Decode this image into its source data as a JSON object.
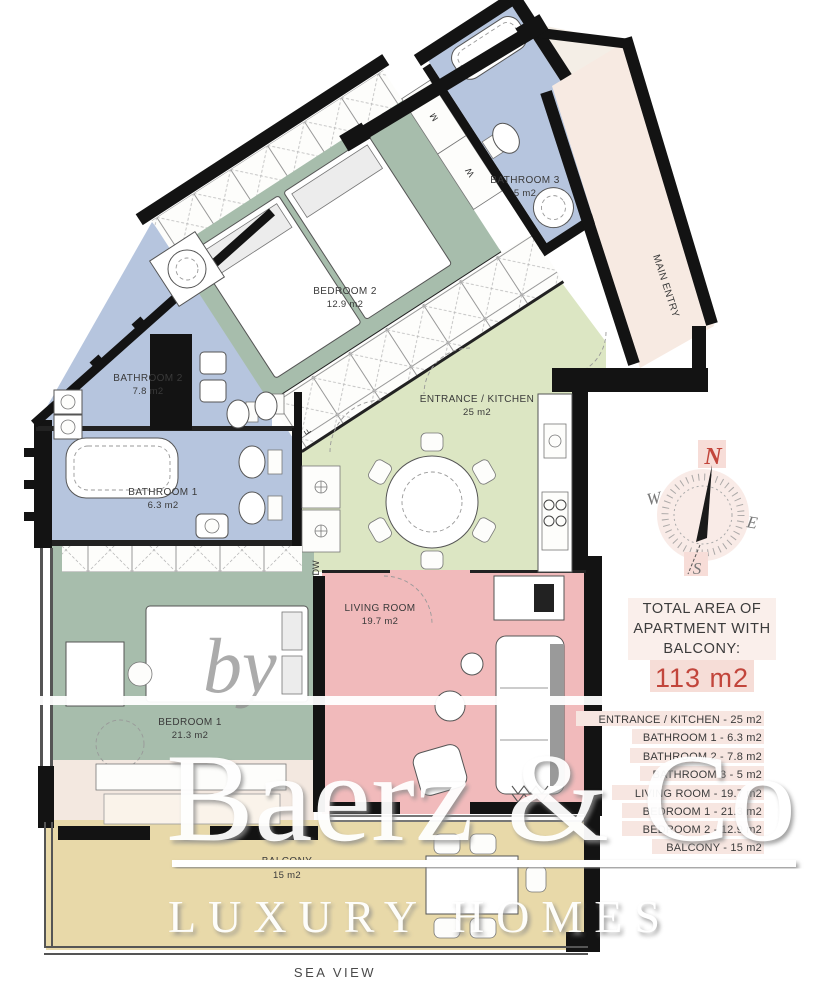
{
  "plan": {
    "rooms": [
      {
        "id": "bedroom2",
        "name": "BEDROOM 2",
        "area": "12.9 m2"
      },
      {
        "id": "bathroom3",
        "name": "BATHROOM 3",
        "area": "5 m2"
      },
      {
        "id": "bathroom2",
        "name": "BATHROOM 2",
        "area": "7.8 m2"
      },
      {
        "id": "bathroom1",
        "name": "BATHROOM 1",
        "area": "6.3 m2"
      },
      {
        "id": "kitchen",
        "name": "ENTRANCE / KITCHEN",
        "area": "25 m2"
      },
      {
        "id": "living",
        "name": "LIVING ROOM",
        "area": "19.7 m2"
      },
      {
        "id": "bedroom1",
        "name": "BEDROOM 1",
        "area": "21.3 m2"
      },
      {
        "id": "balcony",
        "name": "BALCONY",
        "area": "15 m2"
      }
    ],
    "annotations": {
      "main_entry": "MAIN ENTRY",
      "sea_view": "SEA VIEW",
      "dw": "DW",
      "f": "F",
      "m": "M",
      "w": "W"
    }
  },
  "compass": {
    "north": "N",
    "east": "E",
    "south": "S",
    "west": "W"
  },
  "summary": {
    "title": [
      "TOTAL AREA OF",
      "APARTMENT WITH",
      "BALCONY:"
    ],
    "total": "113 m2"
  },
  "legend": {
    "items": [
      "ENTRANCE / KITCHEN - 25 m2",
      "BATHROOM 1 - 6.3 m2",
      "BATHROOM 2 - 7.8 m2",
      "BATHROOM 3 - 5 m2",
      "LIVING ROOM - 19.7 m2",
      "BEDROOM 1 - 21.3 m2",
      "BEDROOM 2 - 12.9 m2",
      "BALCONY - 15 m2"
    ]
  },
  "watermark": {
    "by": "by",
    "brand": "Baerz & Co",
    "tagline": "LUXURY HOMES"
  },
  "colors": {
    "bathroom": "#b6c5de",
    "bedroom": "#a7bdac",
    "kitchen": "#dce6c3",
    "living": "#f1babb",
    "balcony": "#e8d9a9",
    "corridor": "#f4eee6",
    "wall": "#131313",
    "accent_red": "#c2453b",
    "highlight": "#f7e6e1"
  }
}
